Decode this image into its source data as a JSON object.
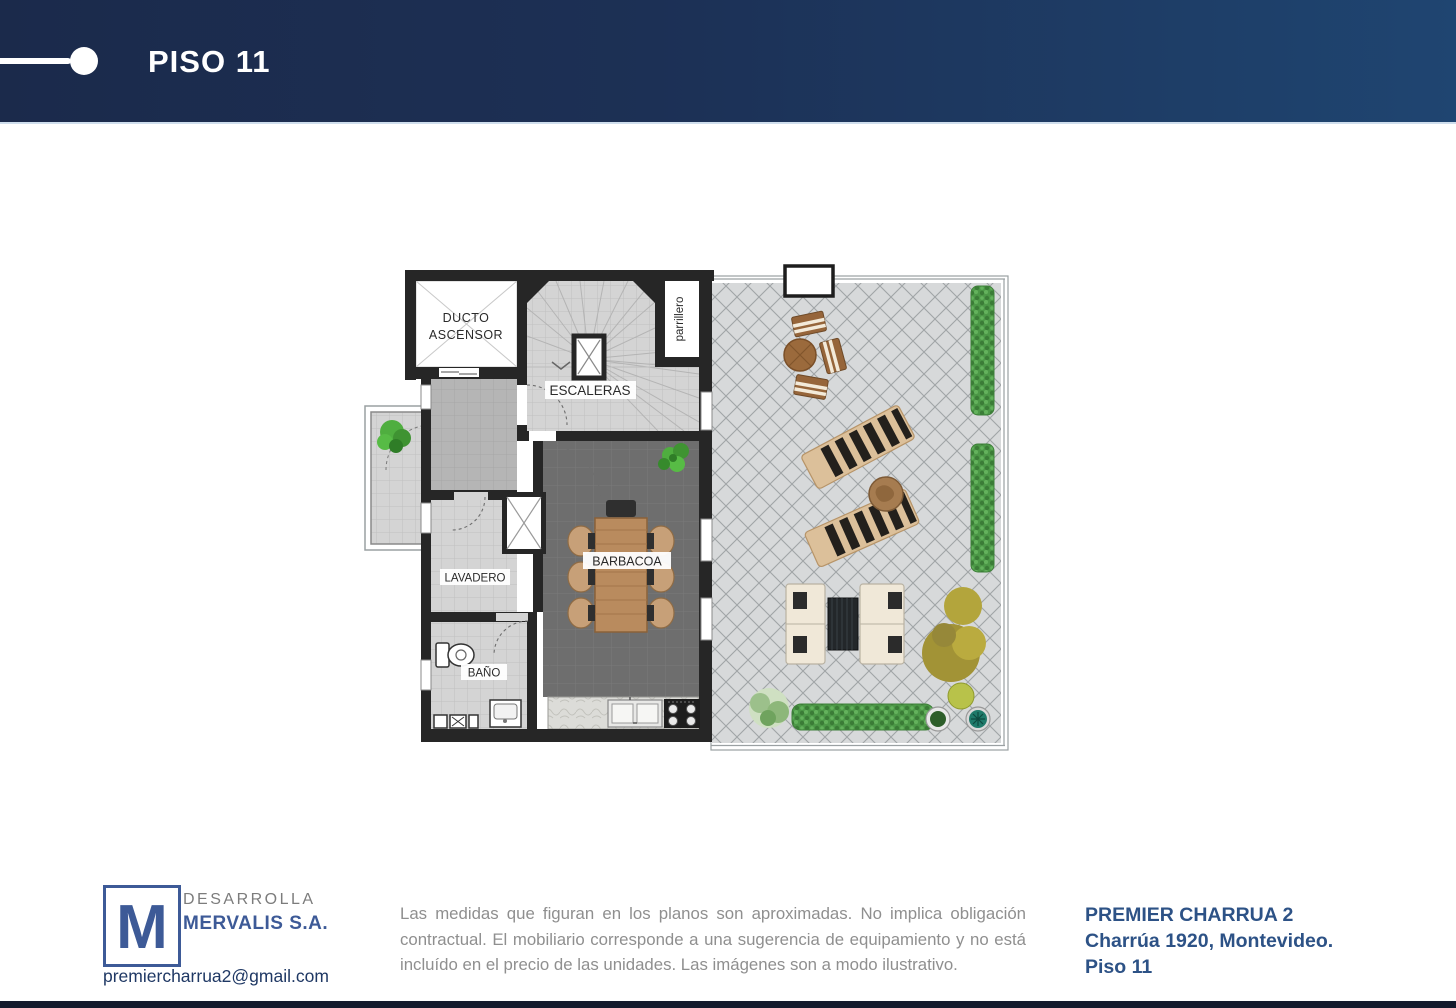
{
  "header": {
    "title": "PISO 11"
  },
  "floor_plan": {
    "rooms": {
      "ducto_line1": "DUCTO",
      "ducto_line2": "ASCENSOR",
      "escaleras": "ESCALERAS",
      "parrillero": "parrillero",
      "lavadero": "LAVADERO",
      "barbacoa": "BARBACOA",
      "bano": "BAÑO"
    }
  },
  "footer": {
    "logo": {
      "letter": "M",
      "line1": "DESARROLLA",
      "line2": "MERVALIS S.A."
    },
    "email": "premiercharrua2@gmail.com",
    "disclaimer": "Las medidas que figuran en los planos son aproximadas. No implica obligación contractual. El mobiliario corresponde a una sugerencia de equipamiento y no está incluído en el precio de las unidades. Las imágenes son a modo ilustrativo.",
    "project": {
      "name": "PREMIER CHARRUA 2",
      "address": "Charrúa 1920, Montevideo.",
      "floor": "Piso 11"
    }
  },
  "colors": {
    "header_navy_left": "#1b2a4b",
    "header_navy_right": "#1f4571",
    "brand_blue": "#3d5a97",
    "email_navy": "#1f3864",
    "project_blue": "#2d5286",
    "disclaimer_gray": "#8f8f8f",
    "wall_black": "#262626",
    "terrace_gray": "#d7d9da",
    "barbacoa_gray": "#6e6e6e",
    "hedge_green": "#4c9847",
    "wood_brown": "#b5875a"
  }
}
